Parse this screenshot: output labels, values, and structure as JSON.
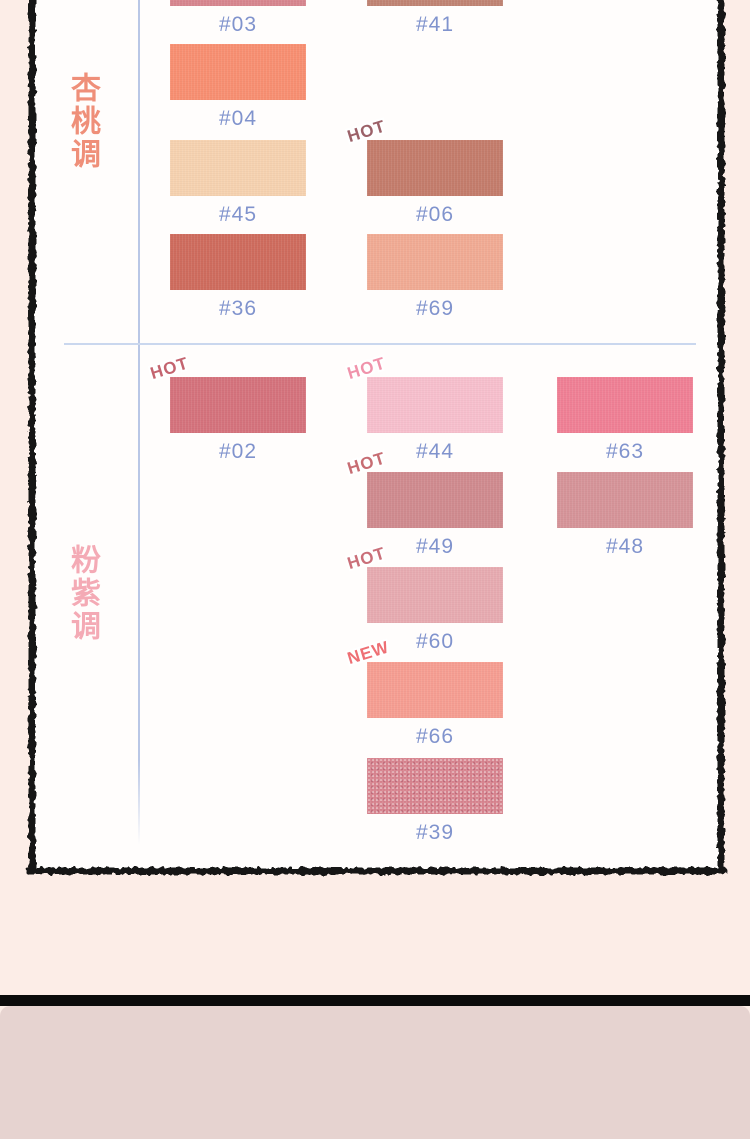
{
  "page": {
    "background_color": "#fcede7",
    "panel_background": "#fffdfc",
    "panel_border_color": "#151515",
    "guide_line_color": "#b9c7e6",
    "code_label_color": "#8093cd",
    "footer_bar_color": "#0b0b0b",
    "footer_panel_color": "#e6d3d0"
  },
  "sections": [
    {
      "id": "apricot",
      "label": "杏桃调",
      "label_color": "#ef8f79",
      "swatches": [
        {
          "code": "#03",
          "color": "#d7868f",
          "row": 0,
          "col": 0
        },
        {
          "code": "#41",
          "color": "#c08474",
          "row": 0,
          "col": 1
        },
        {
          "code": "#04",
          "color": "#f88f72",
          "row": 1,
          "col": 0
        },
        {
          "code": "#45",
          "color": "#f6d2b0",
          "row": 2,
          "col": 0
        },
        {
          "code": "#06",
          "color": "#c47d6c",
          "row": 2,
          "col": 1,
          "badge": "HOT",
          "badge_color": "#9c6168"
        },
        {
          "code": "#36",
          "color": "#cf6c5e",
          "row": 3,
          "col": 0
        },
        {
          "code": "#69",
          "color": "#f1ab94",
          "row": 3,
          "col": 1
        }
      ]
    },
    {
      "id": "pink-purple",
      "label": "粉紫调",
      "label_color": "#f4aab5",
      "swatches": [
        {
          "code": "#02",
          "color": "#d5737d",
          "row": 0,
          "col": 0,
          "badge": "HOT",
          "badge_color": "#c4646f"
        },
        {
          "code": "#44",
          "color": "#f7bfcd",
          "row": 0,
          "col": 1,
          "badge": "HOT",
          "badge_color": "#f093ab"
        },
        {
          "code": "#63",
          "color": "#f08095",
          "row": 0,
          "col": 2
        },
        {
          "code": "#49",
          "color": "#d08b8f",
          "row": 1,
          "col": 1,
          "badge": "HOT",
          "badge_color": "#c76d73"
        },
        {
          "code": "#48",
          "color": "#d69499",
          "row": 1,
          "col": 2
        },
        {
          "code": "#60",
          "color": "#e7abb1",
          "row": 2,
          "col": 1,
          "badge": "HOT",
          "badge_color": "#ca6f79"
        },
        {
          "code": "#66",
          "color": "#f69e92",
          "row": 3,
          "col": 1,
          "badge": "NEW",
          "badge_color": "#ee6f74"
        },
        {
          "code": "#39",
          "color": "#d8848f",
          "row": 4,
          "col": 1,
          "finish": "shimmer"
        }
      ]
    }
  ]
}
